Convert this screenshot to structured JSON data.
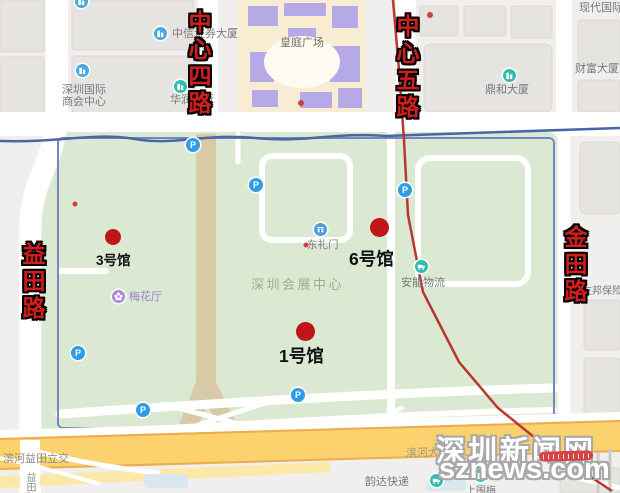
{
  "map_title_context": "深圳会展中心场馆示意图",
  "watermark": {
    "line1": "深圳新闻网",
    "line2": "sznews.com"
  },
  "roads": {
    "zhongxin4": "中心四路",
    "zhongxin5": "中心五路",
    "yitian": "益田路",
    "jintian": "金田路"
  },
  "halls": {
    "hall3": "3号馆",
    "hall6": "6号馆",
    "hall1": "1号馆"
  },
  "parking": {
    "label": "P"
  },
  "pois": {
    "shanghui": "深圳国际商会中心",
    "zhongxin_securities": "中信证券大厦",
    "huarun": "华润银行",
    "huangting": "皇庭广场",
    "dinghe": "鼎和大厦",
    "xiandai": "现代国际",
    "caifu": "财富大厦",
    "donglimen": "东礼门",
    "convention": "深圳会展中心",
    "anneng": "安能物流",
    "meihua": "梅花厅",
    "aia": "友邦保险",
    "binhe_yitian": "滨河益田立交",
    "binhe_dadao": "滨河大道",
    "yitian_road_small": "益田路",
    "yunda": "韵达快递",
    "shangweimei": "上围梅"
  },
  "colors": {
    "annotation_red": "#d31c1c",
    "hall_dot_red": "#c11616",
    "route_line_red": "#b93730",
    "green_area": "#dbe9d2",
    "highway_yellow": "#fcd26e",
    "metro_blue": "#4966a9",
    "parking_blue": "#2f9ce8",
    "poi_teal": "#35bab0",
    "poi_blue": "#4aa8dc",
    "poi_purple": "#a98ae0"
  }
}
